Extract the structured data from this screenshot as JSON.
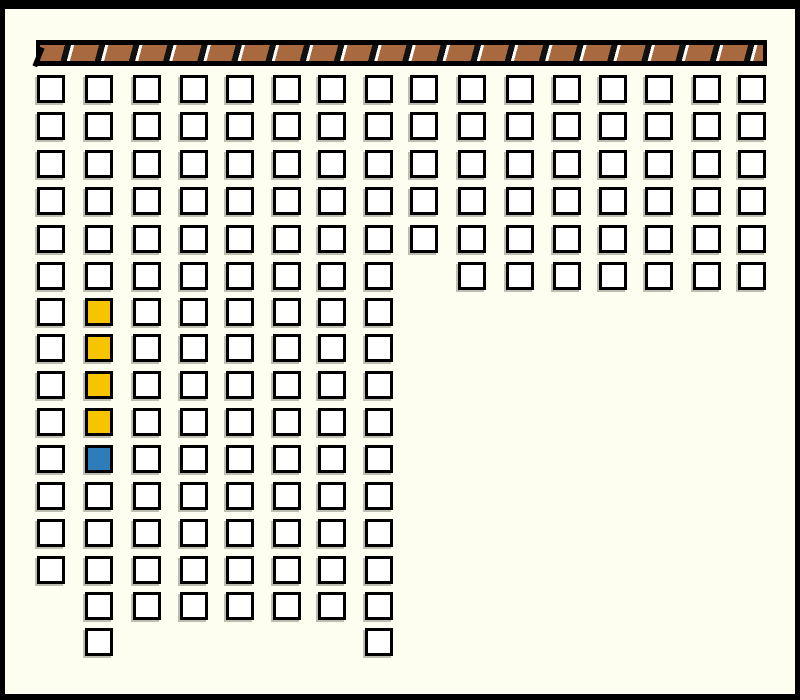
{
  "window": {
    "background": "#FEFEF0",
    "frame_color": "#000000"
  },
  "divider_bar": {
    "fill": "#A8693E",
    "stripe_dark": "#111111",
    "stripe_light": "#FFFFFF",
    "border": "#000000",
    "stripe_period_px": 34
  },
  "cell_colors": {
    "empty": "#FFFFFF",
    "yellow": "#F7C500",
    "blue": "#2E7CB9",
    "border": "#000000"
  },
  "grid": {
    "cols_total": 16,
    "rows_total": 16,
    "total_cells": 168,
    "columns": [
      {
        "col": 1,
        "rows": 14
      },
      {
        "col": 2,
        "rows": 16
      },
      {
        "col": 3,
        "rows": 15
      },
      {
        "col": 4,
        "rows": 15
      },
      {
        "col": 5,
        "rows": 15
      },
      {
        "col": 6,
        "rows": 15
      },
      {
        "col": 7,
        "rows": 15
      },
      {
        "col": 8,
        "rows": 16
      },
      {
        "col": 9,
        "rows": 5
      },
      {
        "col": 10,
        "rows": 6
      },
      {
        "col": 11,
        "rows": 6
      },
      {
        "col": 12,
        "rows": 6
      },
      {
        "col": 13,
        "rows": 6
      },
      {
        "col": 14,
        "rows": 6
      },
      {
        "col": 15,
        "rows": 6
      },
      {
        "col": 16,
        "rows": 6
      }
    ],
    "colored_cells": [
      {
        "col": 2,
        "row": 7,
        "state": "yellow"
      },
      {
        "col": 2,
        "row": 8,
        "state": "yellow"
      },
      {
        "col": 2,
        "row": 9,
        "state": "yellow"
      },
      {
        "col": 2,
        "row": 10,
        "state": "yellow"
      },
      {
        "col": 2,
        "row": 11,
        "state": "blue"
      }
    ]
  }
}
